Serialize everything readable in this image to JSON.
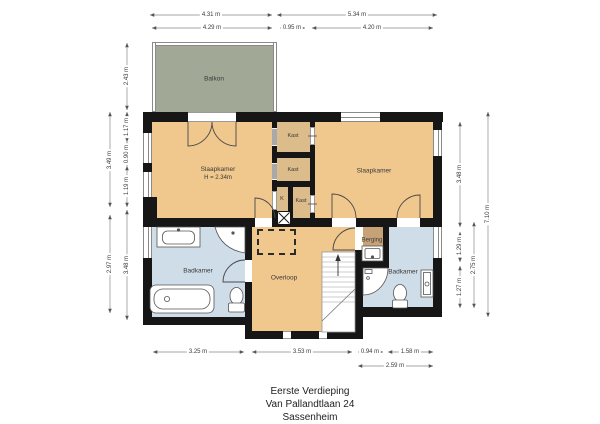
{
  "meta": {
    "floor": "Eerste Verdieping",
    "address": "Van Pallandtlaan 24",
    "city": "Sassenheim"
  },
  "rooms": {
    "balkon": "Balkon",
    "slaapkamer_left": "Slaapkamer",
    "slaapkamer_left_height": "H = 2.34m",
    "slaapkamer_right": "Slaapkamer",
    "kast1": "Kast",
    "kast2": "Kast",
    "kast3": "Kast",
    "shaft": "K",
    "badkamer_left": "Badkamer",
    "overloop": "Overloop",
    "berging": "Berging",
    "badkamer_right": "Badkamer"
  },
  "dimensions": {
    "top_outer": [
      "4.31 m",
      "5.34 m"
    ],
    "top_inner": [
      "4.29 m",
      "0.95 m",
      "4.20 m"
    ],
    "bottom_inner": [
      "3.25 m",
      "3.53 m",
      "0.94 m",
      "1.58 m"
    ],
    "bottom_outer": [
      "2.59 m"
    ],
    "left_outer": [
      "3.49 m",
      "2.97 m"
    ],
    "left_inner": [
      "2.43 m",
      "1.17 m",
      "0.90 m",
      "1.19 m",
      "3.48 m"
    ],
    "right_inner": [
      "3.48 m",
      "1.29 m",
      "1.27 m"
    ],
    "right_mid": [
      "2.75 m"
    ],
    "right_outer": [
      "7.10 m"
    ]
  },
  "colors": {
    "wall": "#161616",
    "bedroom_floor": "#f0c78c",
    "closet_floor": "#dbbc8a",
    "bathroom_floor": "#cfdde9",
    "storage_floor": "#c8a277",
    "balcony_floor": "#a2a896"
  }
}
